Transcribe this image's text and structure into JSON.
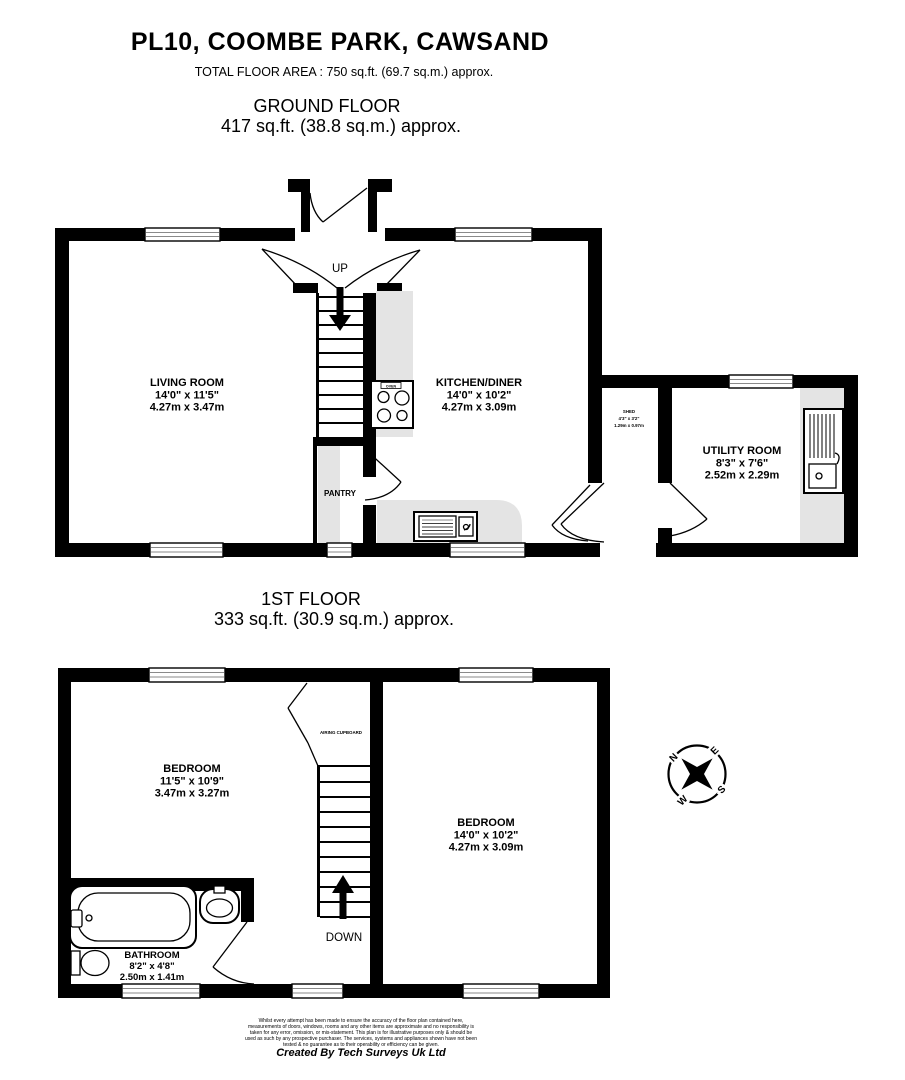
{
  "header": {
    "title": "PL10, COOMBE PARK, CAWSAND",
    "total_area": "TOTAL FLOOR AREA : 750 sq.ft. (69.7 sq.m.) approx."
  },
  "ground_floor": {
    "heading": "GROUND FLOOR",
    "area": "417 sq.ft. (38.8 sq.m.) approx.",
    "rooms": {
      "living_room": {
        "name": "LIVING ROOM",
        "imperial": "14'0\" x 11'5\"",
        "metric": "4.27m x 3.47m"
      },
      "kitchen": {
        "name": "KITCHEN/DINER",
        "imperial": "14'0\" x 10'2\"",
        "metric": "4.27m x 3.09m"
      },
      "shed": {
        "name": "SHED",
        "imperial": "4'3\" x 3'2\"",
        "metric": "1.29m x 0.97m"
      },
      "utility": {
        "name": "UTILITY ROOM",
        "imperial": "8'3\" x 7'6\"",
        "metric": "2.52m x 2.29m"
      }
    },
    "labels": {
      "up": "UP",
      "pantry": "PANTRY",
      "oven": "OVEN"
    }
  },
  "first_floor": {
    "heading": "1ST FLOOR",
    "area": "333 sq.ft. (30.9 sq.m.) approx.",
    "rooms": {
      "bedroom1": {
        "name": "BEDROOM",
        "imperial": "11'5\" x 10'9\"",
        "metric": "3.47m x 3.27m"
      },
      "bedroom2": {
        "name": "BEDROOM",
        "imperial": "14'0\" x 10'2\"",
        "metric": "4.27m x 3.09m"
      },
      "bathroom": {
        "name": "BATHROOM",
        "imperial": "8'2\" x 4'8\"",
        "metric": "2.50m x 1.41m"
      }
    },
    "labels": {
      "down": "DOWN",
      "airing_cupboard": "AIRING CUPBOARD"
    }
  },
  "compass": {
    "n": "N",
    "e": "E",
    "s": "S",
    "w": "W"
  },
  "footer": {
    "disclaimer_lines": [
      "Whilst every attempt has been made to ensure the accuracy of the floor plan contained here,",
      "measurements of doors, windows, rooms and any other items are approximate and no responsibility is",
      "taken for any error, omission, or mis-statement. This plan is for illustrative purposes only & should be",
      "used as such by any prospective purchaser. The services, systems and appliances shown have not been",
      "tested & no guarantee as to their operability or efficiency can be given."
    ],
    "credit": "Created By Tech Surveys Uk Ltd"
  },
  "colors": {
    "wall": "#000000",
    "counter": "#e4e4e4",
    "background": "#ffffff"
  }
}
